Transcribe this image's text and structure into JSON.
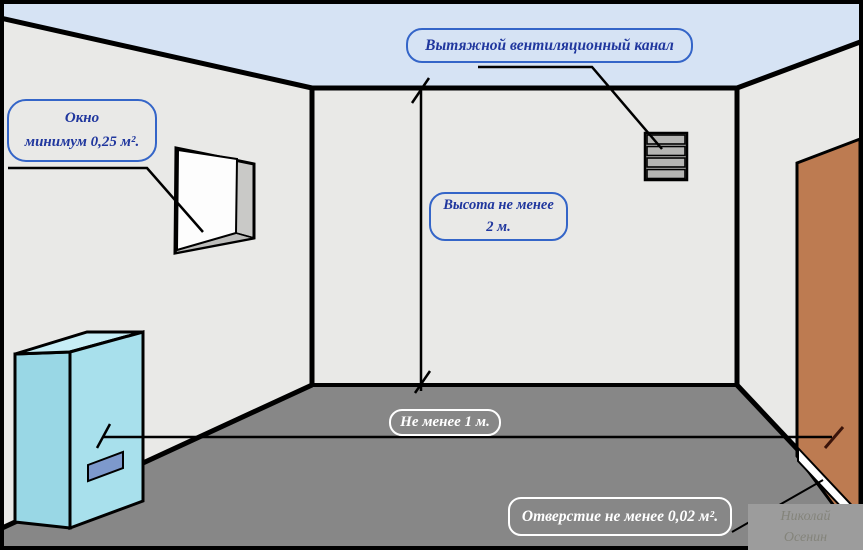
{
  "diagram": {
    "title_hint": "Boiler room requirements scheme",
    "labels": {
      "vent_channel": "Вытяжной вентиляционный канал",
      "window_line1": "Окно",
      "window_line2": "минимум 0,25 м².",
      "height_line1": "Высота не менее",
      "height_line2": "2 м.",
      "floor_distance": "Не менее 1 м.",
      "door_opening": "Отверстие не менее 0,02 м²."
    },
    "watermark": {
      "line1": "Николай",
      "line2": "Осенин"
    },
    "colors": {
      "ceiling": "#d6e3f4",
      "walls": "#e9e9e7",
      "floor": "#878787",
      "boiler_front": "#a8e0ec",
      "boiler_side": "#99d7e5",
      "boiler_top": "#c7eef6",
      "boiler_panel": "#7d99cc",
      "door": "#bd7b51",
      "window_jamb": "#c9c9c7",
      "grille": "#b5b5b3",
      "callout_blue_border": "#3465c8",
      "callout_blue_text": "#20379e",
      "callout_white": "#ffffff",
      "outline": "#000000",
      "watermark_bg": "#9c9c9c",
      "watermark_text": "#84847b"
    }
  }
}
